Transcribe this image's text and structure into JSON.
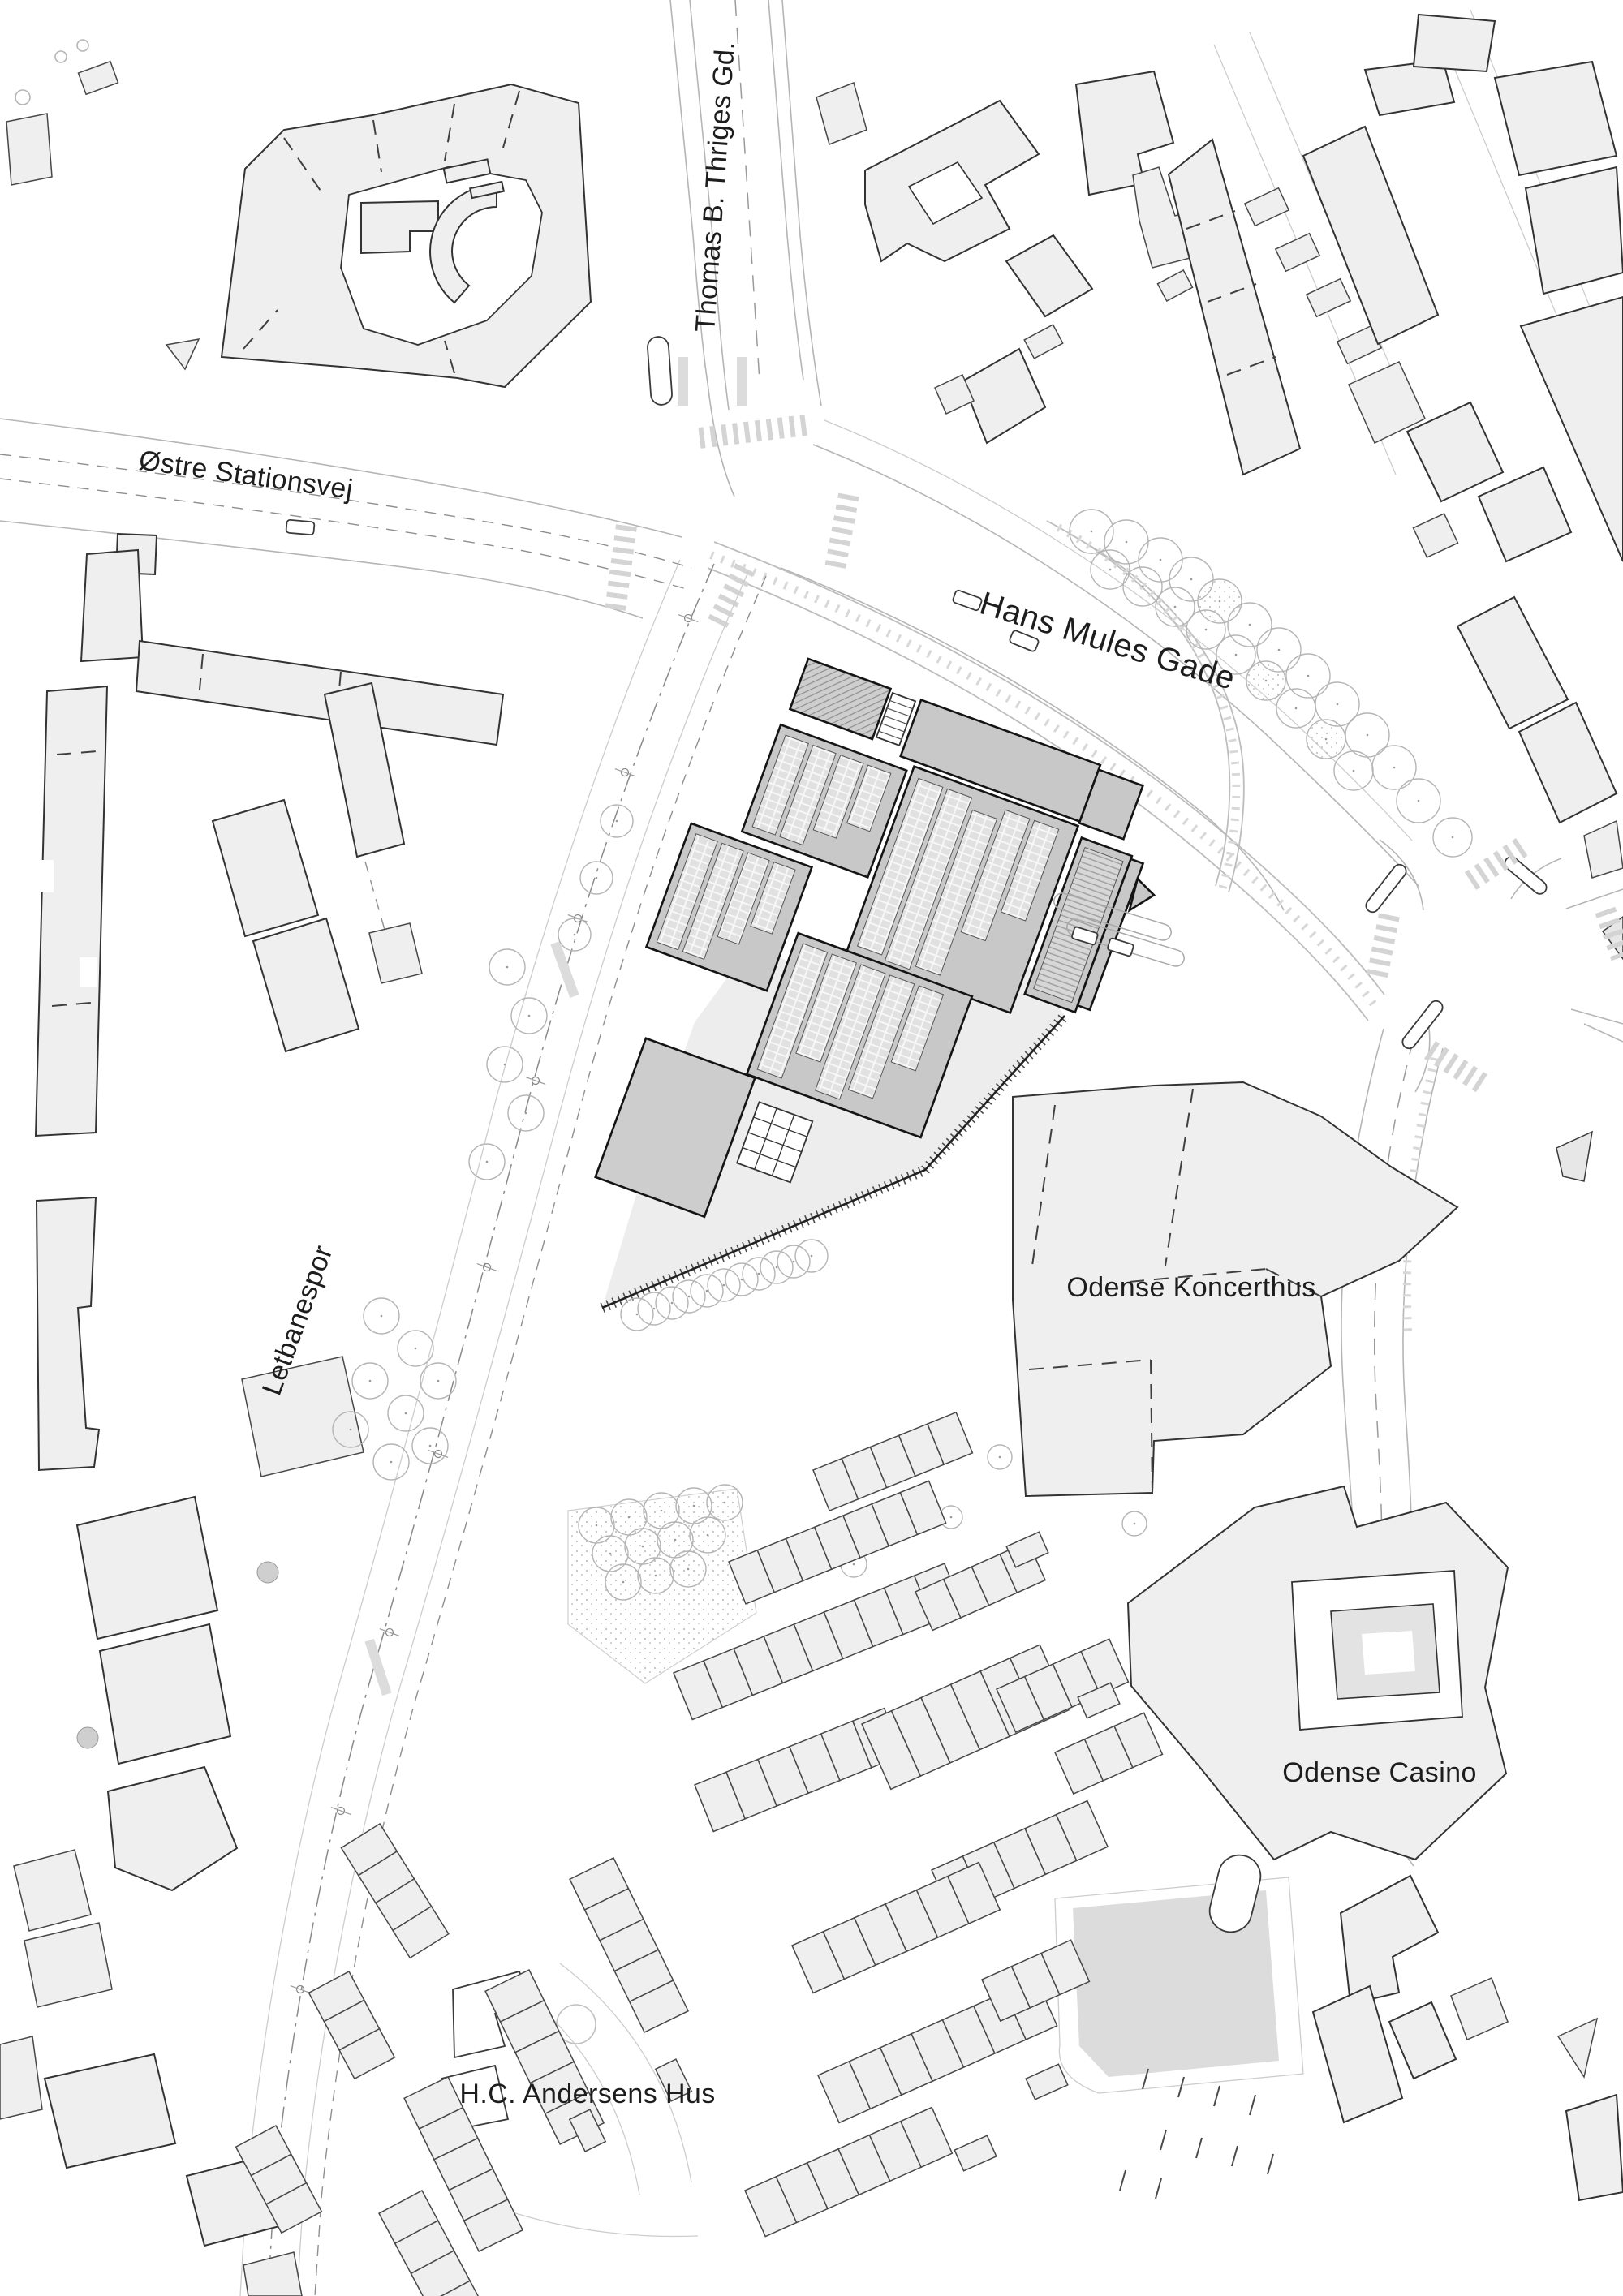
{
  "map": {
    "street_labels": {
      "thomas_b_thriges_gd": "Thomas B. Thriges Gd.",
      "ostre_stationsvej": "Østre Stationsvej",
      "hans_mules_gade": "Hans Mules Gade",
      "letbanespor": "Letbanespor"
    },
    "landmark_labels": {
      "odense_koncerthus": "Odense Koncerthus",
      "odense_casino": "Odense Casino",
      "hc_andersens_hus": "H.C. Andersens Hus"
    },
    "colors": {
      "background": "#ffffff",
      "building_fill": "#efefef",
      "building_stroke": "#333333",
      "complex_fill": "#c8c8c8",
      "complex_cell": "#e1e1e1",
      "complex_stroke": "#141414",
      "plaza_fill": "#ededed",
      "field_fill": "#dcdcdc",
      "road_line": "#b5b5b5",
      "zebra": "#d4d4d4",
      "tree_stroke": "#b5b5b5",
      "label_color": "#1d1d1d"
    }
  }
}
